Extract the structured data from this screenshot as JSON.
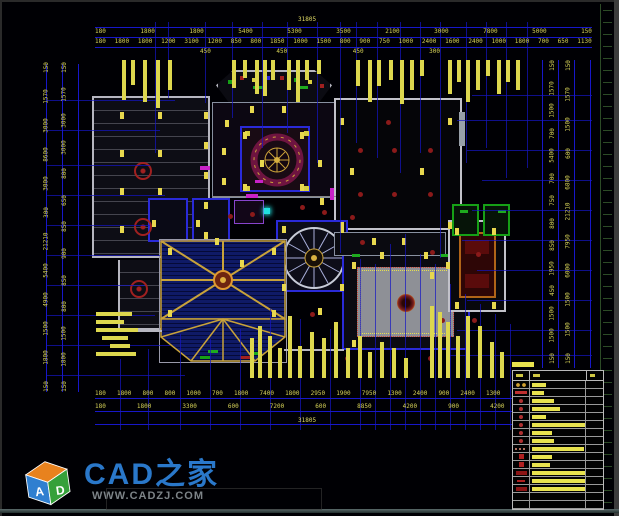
{
  "dims": {
    "top": {
      "total": "31805",
      "row1": [
        "180",
        "1800",
        "1800",
        "5400",
        "5300",
        "3500",
        "2100",
        "3000",
        "7800",
        "5000",
        "150"
      ],
      "row2": [
        "180",
        "1800",
        "1800",
        "1200",
        "3100",
        "1200",
        "850",
        "800",
        "1850",
        "1000",
        "1500",
        "800",
        "900",
        "750",
        "1000",
        "2400",
        "1600",
        "2400",
        "1000",
        "1800",
        "700",
        "650",
        "1130"
      ],
      "sub": [
        "450",
        "450",
        "450",
        "300"
      ]
    },
    "bottom": {
      "row1": [
        "180",
        "1800",
        "800",
        "800",
        "1000",
        "700",
        "1800",
        "7400",
        "1800",
        "2950",
        "1900",
        "7950",
        "1300",
        "2400",
        "900",
        "2400",
        "1300",
        "900",
        "2100",
        "900",
        "120"
      ],
      "row2": [
        "180",
        "1800",
        "3300",
        "600",
        "7200",
        "600",
        "8850",
        "4200",
        "900",
        "4200",
        "4700",
        "120"
      ],
      "total": "31805"
    },
    "left": {
      "col_a": [
        "150",
        "1570",
        "3000",
        "8600",
        "3000",
        "300",
        "21210",
        "5400",
        "4900",
        "1500",
        "1800",
        "150"
      ],
      "col_b": [
        "150",
        "1570",
        "3000",
        "3000",
        "800",
        "650",
        "850",
        "900",
        "850",
        "800",
        "1500",
        "1800",
        "150"
      ]
    },
    "right": {
      "col_a": [
        "150",
        "1570",
        "1500",
        "700",
        "5400",
        "700",
        "750",
        "800",
        "850",
        "1950",
        "450",
        "1500",
        "1500",
        "150"
      ],
      "col_b": [
        "150",
        "1570",
        "1500",
        "600",
        "6800",
        "21210",
        "7950",
        "6000",
        "1500",
        "1500",
        "150"
      ]
    }
  },
  "legend": {
    "rows": [
      {
        "sym": "rings",
        "w": 14
      },
      {
        "sym": "redbar",
        "w": 12
      },
      {
        "sym": "dot",
        "w": 22
      },
      {
        "sym": "dot",
        "w": 28
      },
      {
        "sym": "dot",
        "w": 14
      },
      {
        "sym": "dot",
        "w": 56
      },
      {
        "sym": "dot",
        "w": 20
      },
      {
        "sym": "dot",
        "w": 22
      },
      {
        "sym": "dashes",
        "w": 52
      },
      {
        "sym": "square",
        "w": 20
      },
      {
        "sym": "square",
        "w": 18
      },
      {
        "sym": "block",
        "w": 54
      },
      {
        "sym": "dash",
        "w": 62
      },
      {
        "sym": "block",
        "w": 58
      },
      {
        "sym": "none",
        "w": 0
      },
      {
        "sym": "none",
        "w": 0
      }
    ]
  },
  "watermark": {
    "brand": "CAD之家",
    "site": "WWW.CADZJ.COM",
    "cube_letters": [
      "A",
      "D"
    ]
  },
  "colors": {
    "background": "#000004",
    "dimension_line": "#1717c9",
    "dimension_text": "#d6d258",
    "wall": "#c0c0c8",
    "accent_red": "#a02020",
    "accent_yellow": "#e8e24e",
    "ceiling_blue": "#0f1a66",
    "pool_gray": "#8e9096",
    "brand_blue": "#2f85e0"
  }
}
